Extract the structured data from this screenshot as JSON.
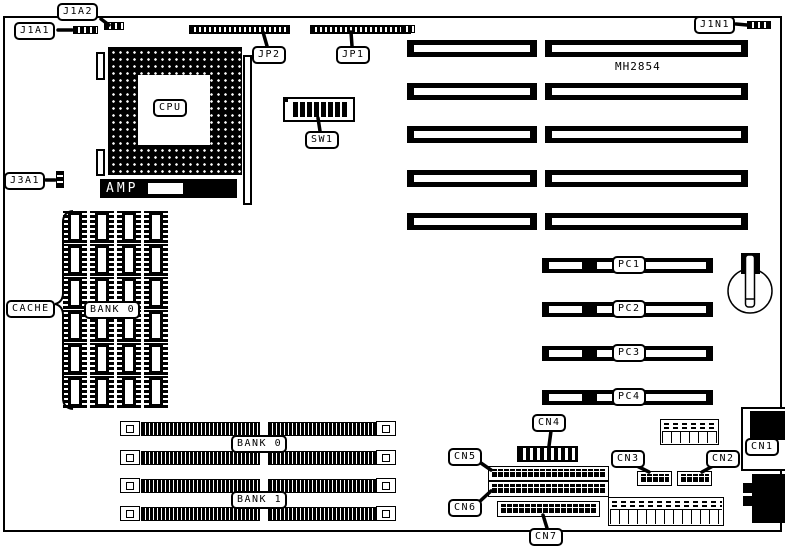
{
  "diagram": {
    "type": "motherboard-layout",
    "colors": {
      "ink": "#000000",
      "background": "#ffffff"
    },
    "labels": {
      "j1a1": "J1A1",
      "j1a2": "J1A2",
      "j3a1": "J3A1",
      "j1n1": "J1N1",
      "jp1": "JP1",
      "jp2": "JP2",
      "sw1": "SW1",
      "cpu": "CPU",
      "amp": "AMP",
      "chip_marking": "MH2854",
      "cache": "CACHE",
      "cache_bank": "BANK 0",
      "simm_bank0": "BANK 0",
      "simm_bank1": "BANK 1",
      "pc1": "PC1",
      "pc2": "PC2",
      "pc3": "PC3",
      "pc4": "PC4",
      "cn1": "CN1",
      "cn2": "CN2",
      "cn3": "CN3",
      "cn4": "CN4",
      "cn5": "CN5",
      "cn6": "CN6",
      "cn7": "CN7"
    }
  }
}
